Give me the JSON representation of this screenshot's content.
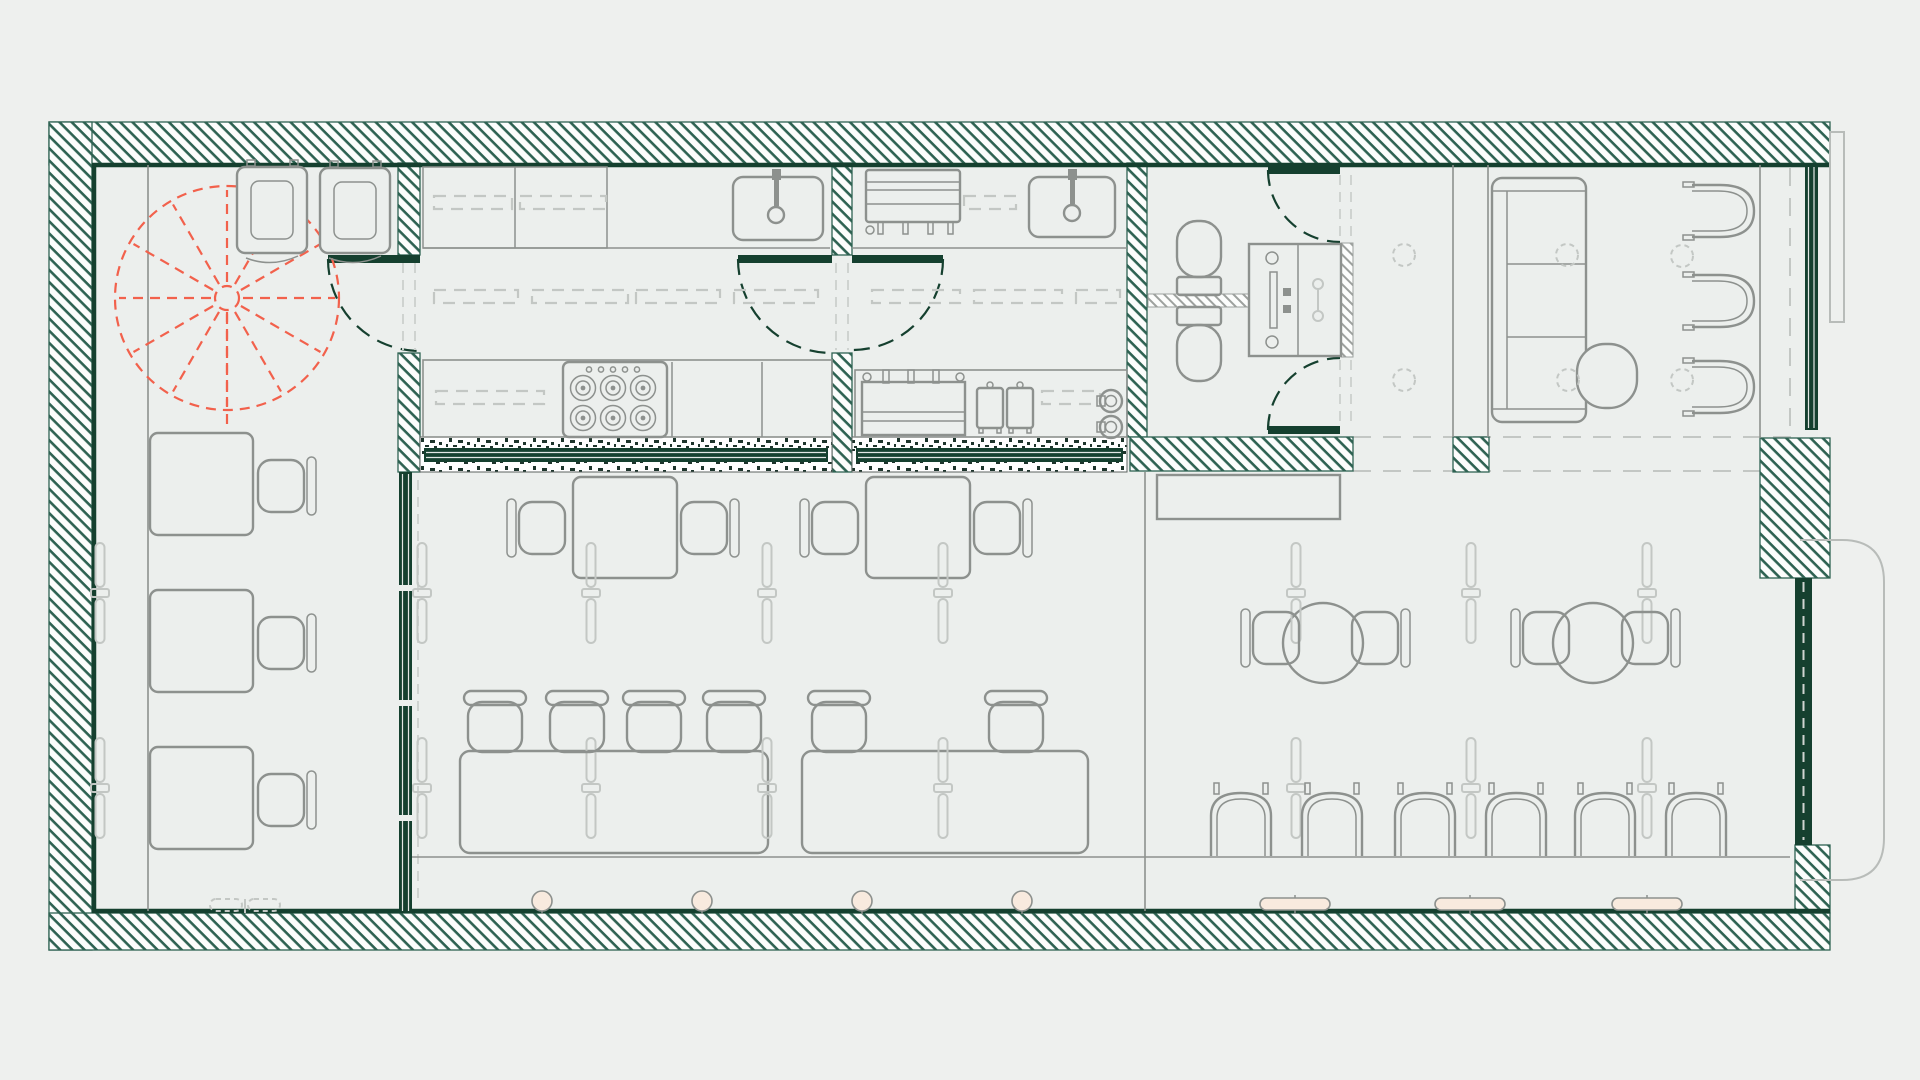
{
  "meta": {
    "drawing_type": "floor-plan",
    "visible_text": "none"
  },
  "canvas": {
    "width": 1920,
    "height": 1080
  },
  "palette": {
    "page_bg": "#eef0ee",
    "floor": "#ecefed",
    "hatch_bg": "#fcfdfc",
    "wall_green": "#2e6252",
    "wall_dark": "#15402f",
    "furn": "#8d918e",
    "furn_light": "#c3c7c4",
    "dash": "#cfd3d0",
    "red": "#f2614c",
    "peach": "#f8eade",
    "speckle_dark": "#1d342b",
    "hatch_gray": "#9da19e",
    "ext": "#b8bcb9"
  },
  "inventory": {
    "spiral_staircase": 1,
    "refrigerators": 2,
    "kitchen_sinks": 2,
    "stove_burners": 6,
    "fryers": 2,
    "toilets": 2,
    "washbasin_unit": 1,
    "square_tables": 5,
    "communal_tables": 2,
    "round_tables": 2,
    "dining_chairs": 11,
    "bar_stools": 6,
    "cafe_chairs": 6,
    "lounge_armchairs": 3,
    "sofa": 1,
    "pouf": 1,
    "doors": 5,
    "pendant_lights": 16,
    "ceiling_lights": 6
  },
  "furniture": {
    "instances": [
      {
        "use": "capsule-light",
        "x": 100,
        "y": 543
      },
      {
        "use": "capsule-light",
        "x": 100,
        "y": 738
      },
      {
        "use": "capsule-light",
        "x": 422,
        "y": 543
      },
      {
        "use": "capsule-light",
        "x": 422,
        "y": 738
      },
      {
        "use": "capsule-light",
        "x": 591,
        "y": 543
      },
      {
        "use": "capsule-light",
        "x": 591,
        "y": 738
      },
      {
        "use": "capsule-light",
        "x": 767,
        "y": 543
      },
      {
        "use": "capsule-light",
        "x": 767,
        "y": 738
      },
      {
        "use": "capsule-light",
        "x": 943,
        "y": 543
      },
      {
        "use": "capsule-light",
        "x": 943,
        "y": 738
      },
      {
        "use": "capsule-light",
        "x": 1296,
        "y": 543
      },
      {
        "use": "capsule-light",
        "x": 1296,
        "y": 738
      },
      {
        "use": "capsule-light",
        "x": 1471,
        "y": 543
      },
      {
        "use": "capsule-light",
        "x": 1471,
        "y": 738
      },
      {
        "use": "capsule-light",
        "x": 1647,
        "y": 543
      },
      {
        "use": "capsule-light",
        "x": 1647,
        "y": 738
      },
      {
        "use": "dash-circle",
        "x": 1404,
        "y": 255
      },
      {
        "use": "dash-circle",
        "x": 1404,
        "y": 380
      },
      {
        "use": "dash-circle",
        "x": 1567,
        "y": 255
      },
      {
        "use": "dash-circle",
        "x": 1568,
        "y": 380
      },
      {
        "use": "dash-circle",
        "x": 1682,
        "y": 256
      },
      {
        "use": "dash-circle",
        "x": 1682,
        "y": 380
      },
      {
        "use": "chair-right-back",
        "x": 258,
        "y": 460
      },
      {
        "use": "chair-right-back",
        "x": 258,
        "y": 617
      },
      {
        "use": "chair-right-back",
        "x": 258,
        "y": 774
      },
      {
        "use": "chair-left-back",
        "x": 519,
        "y": 502
      },
      {
        "use": "chair-right-back",
        "x": 681,
        "y": 502
      },
      {
        "use": "chair-left-back",
        "x": 812,
        "y": 502
      },
      {
        "use": "chair-right-back",
        "x": 974,
        "y": 502
      },
      {
        "use": "chair-left-back",
        "x": 1253,
        "y": 612
      },
      {
        "use": "chair-right-back",
        "x": 1352,
        "y": 612
      },
      {
        "use": "chair-left-back",
        "x": 1523,
        "y": 612
      },
      {
        "use": "chair-right-back",
        "x": 1622,
        "y": 612
      },
      {
        "use": "stool",
        "x": 468,
        "y": 702
      },
      {
        "use": "stool",
        "x": 550,
        "y": 702
      },
      {
        "use": "stool",
        "x": 627,
        "y": 702
      },
      {
        "use": "stool",
        "x": 707,
        "y": 702
      },
      {
        "use": "stool",
        "x": 812,
        "y": 702
      },
      {
        "use": "stool",
        "x": 989,
        "y": 702
      },
      {
        "use": "arch-chair",
        "x": 1210,
        "y": 792
      },
      {
        "use": "arch-chair",
        "x": 1301,
        "y": 792
      },
      {
        "use": "arch-chair",
        "x": 1394,
        "y": 792
      },
      {
        "use": "arch-chair",
        "x": 1485,
        "y": 792
      },
      {
        "use": "arch-chair",
        "x": 1574,
        "y": 792
      },
      {
        "use": "arch-chair",
        "x": 1665,
        "y": 792
      },
      {
        "use": "armchair",
        "x": 1692,
        "y": 184
      },
      {
        "use": "armchair",
        "x": 1692,
        "y": 274
      },
      {
        "use": "armchair",
        "x": 1692,
        "y": 360
      },
      {
        "use": "peach-dot",
        "x": 542,
        "y": 901
      },
      {
        "use": "peach-dot",
        "x": 702,
        "y": 901
      },
      {
        "use": "peach-dot",
        "x": 862,
        "y": 901
      },
      {
        "use": "peach-dot",
        "x": 1022,
        "y": 901
      },
      {
        "use": "peach-bar",
        "x": 1295,
        "y": 898
      },
      {
        "use": "peach-bar",
        "x": 1470,
        "y": 898
      },
      {
        "use": "peach-bar",
        "x": 1647,
        "y": 898
      }
    ]
  }
}
